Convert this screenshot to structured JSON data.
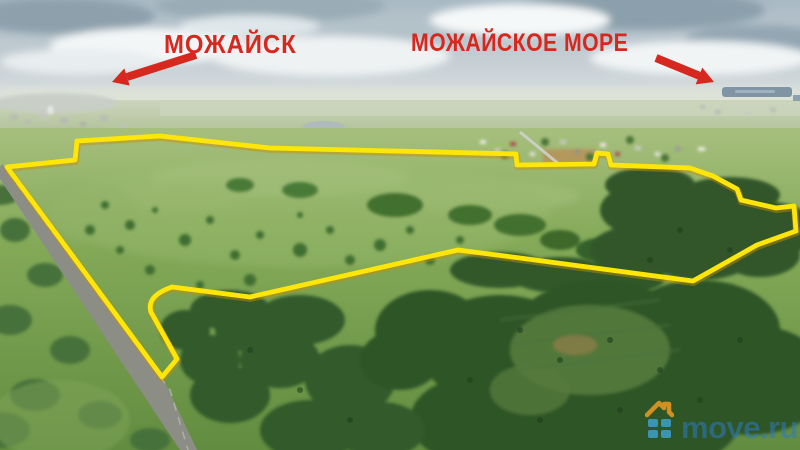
{
  "annotations": {
    "city_label": "МОЖАЙСК",
    "sea_label": "МОЖАЙСКОЕ МОРЕ",
    "color": "#d6281e"
  },
  "boundary": {
    "color": "#ffe609",
    "shadow_color": "#c98f00"
  },
  "watermark": {
    "text": "move.ru",
    "text_color": "#2d7ac0",
    "roof_color": "#f59d1f",
    "squares_color": "#3ea3cf"
  }
}
